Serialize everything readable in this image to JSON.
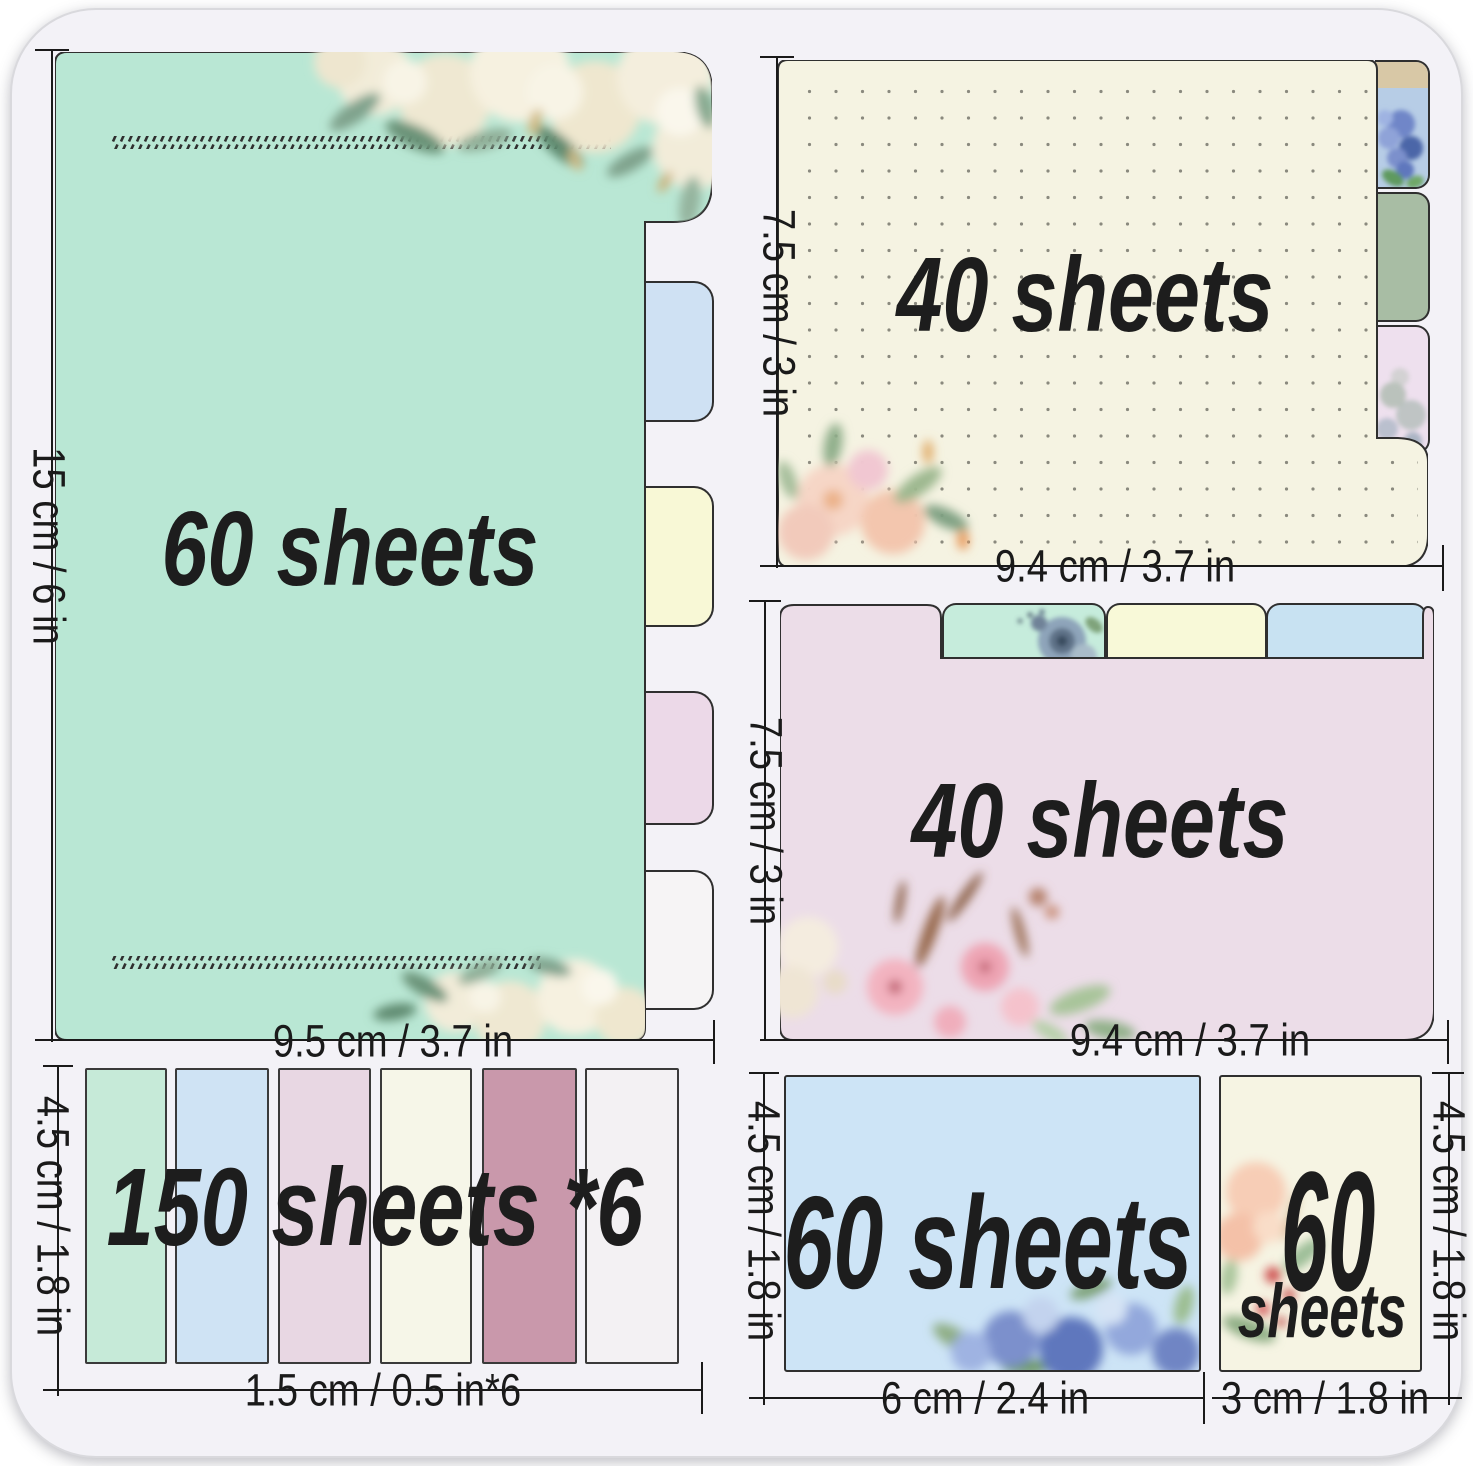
{
  "pads": {
    "lined": {
      "sheets": "60 sheets",
      "height": "15 cm / 6 in",
      "width": "9.5 cm / 3.7 in"
    },
    "dotted": {
      "sheets": "40 sheets",
      "height": "7.5 cm / 3 in",
      "width": "9.4 cm / 3.7 in"
    },
    "pink": {
      "sheets": "40 sheets",
      "height": "7.5 cm / 3 in",
      "width": "9.4 cm / 3.7 in"
    },
    "strips": {
      "sheets": "150 sheets *6",
      "height": "4.5 cm / 1.8 in",
      "width": "1.5 cm / 0.5 in*6"
    },
    "blue": {
      "sheets": "60 sheets",
      "height": "4.5 cm / 1.8 in",
      "width": "6 cm / 2.4 in"
    },
    "mini": {
      "sheets_number": "60",
      "sheets_word": "sheets",
      "height": "4.5 cm / 1.8 in",
      "width": "3 cm / 1.8 in"
    }
  },
  "colors": {
    "bg": "#f3f2f7",
    "outline": "#2f2f2f",
    "ink": "#1d1d1d",
    "dimink": "#1a1a1a",
    "mint": "#b9e7d4",
    "tabblue": "#cfe1f3",
    "tabyellow": "#f8f8d6",
    "tabpink": "#ecd9e8",
    "tabwhite": "#f6f4f5",
    "cream": "#f5f3e2",
    "dotcolor": "#8a897e",
    "hydbg": "#b7cde6",
    "hydband": "#d8c8a6",
    "sage": "#a8bda4",
    "eucpink": "#eee0ee",
    "pinkpad": "#ecdde8",
    "t2mint": "#c6ecdc",
    "t2yellow": "#f8f9d8",
    "t2blue": "#c8e2f2",
    "s1": "#c6ead8",
    "s2": "#cfe3f4",
    "s3": "#e8d7e3",
    "s4": "#f6f6e8",
    "s5": "#c998ab",
    "s6": "#f3f1f3",
    "bluepad": "#cde4f6",
    "minicream": "#f6f4e3"
  }
}
